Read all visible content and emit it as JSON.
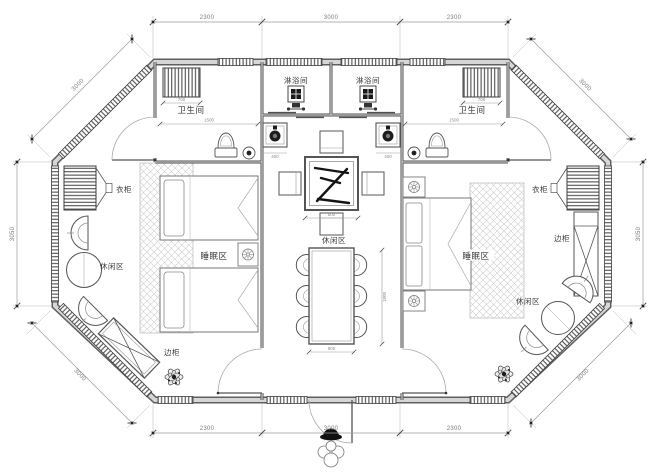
{
  "plan": {
    "rooms": {
      "bathroom": "卫生间",
      "shower": "淋浴间",
      "wardrobe": "衣柜",
      "side_cabinet": "边柜",
      "sleeping": "睡眠区",
      "leisure": "休闲区"
    },
    "dims": {
      "top": [
        "2300",
        "3000",
        "2300"
      ],
      "bottom": [
        "2300",
        "3000",
        "2300"
      ],
      "left": "3050",
      "right": "3050",
      "diag_tl": "3000",
      "diag_tr": "3000",
      "diag_bl": "3000",
      "diag_br": "3000",
      "rack": "700",
      "bath": "1500",
      "basin": "400",
      "square_table": "800",
      "dining_w": "800",
      "dining_l": "1800"
    },
    "colors": {
      "wall_edge": "#5f5f5f",
      "wall_core": "#d6d6d6",
      "line": "#555555",
      "dim_line": "#9a9a9a",
      "carpet_hatch": "#cdcdcd",
      "accent_dark": "#1a1a1a",
      "background": "#ffffff"
    }
  }
}
